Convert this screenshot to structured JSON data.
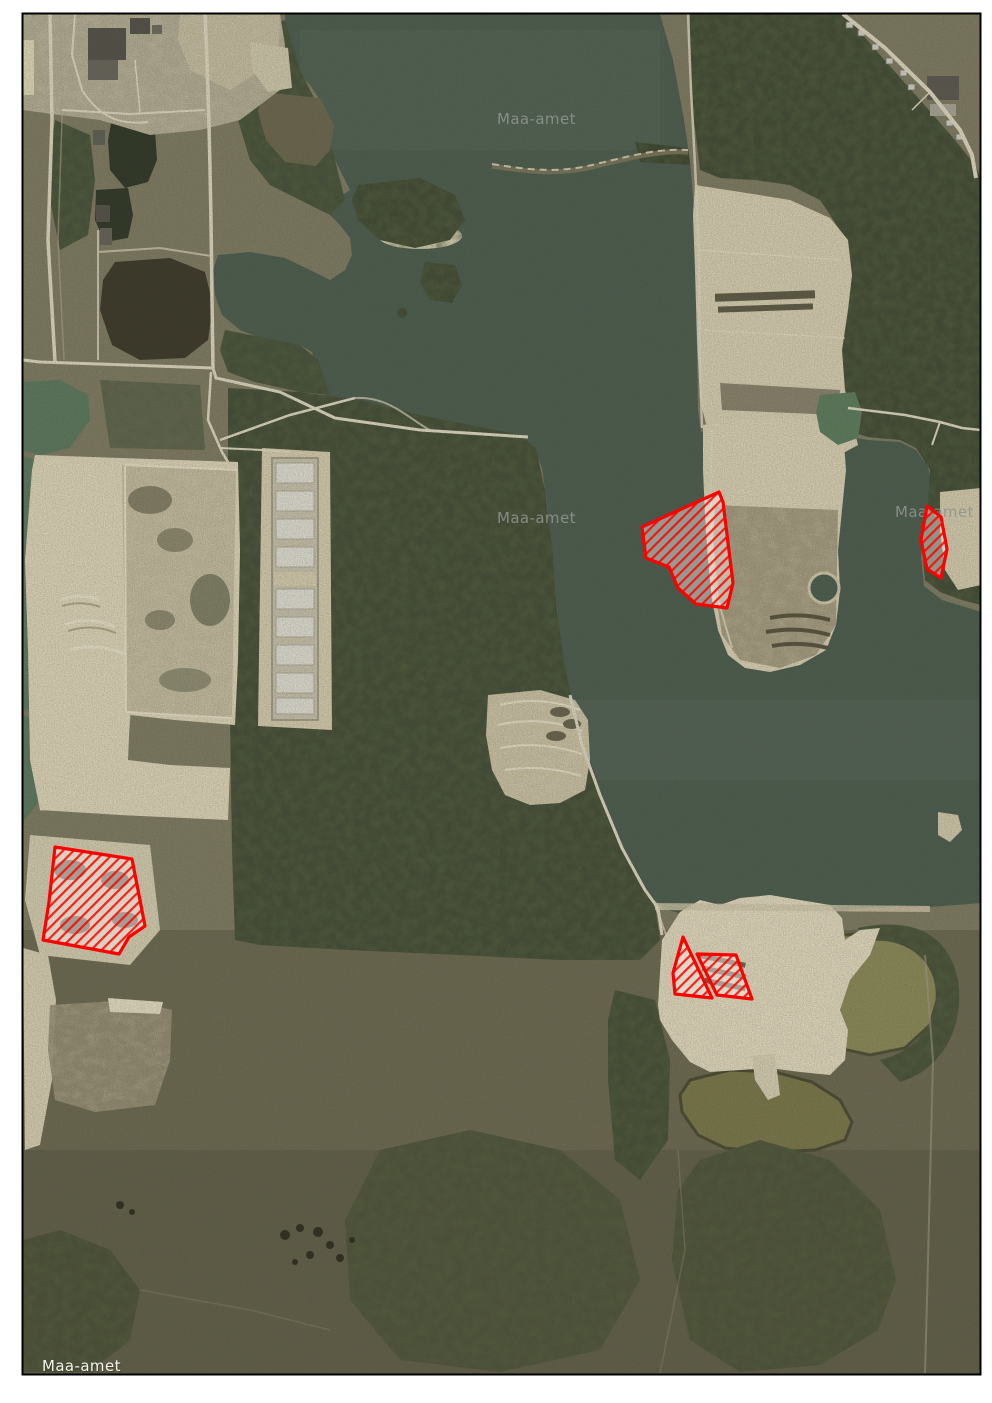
{
  "map": {
    "type": "orthophoto-aerial-map",
    "attribution": "Maa-amet",
    "frame": {
      "x": 22.5,
      "y": 13.5,
      "width": 958,
      "height": 1361,
      "border_color": "#000000",
      "margin_color": "#ffffff"
    },
    "watermarks": [
      {
        "text": "Maa-amet",
        "x": 497,
        "y": 124,
        "style": "gray"
      },
      {
        "text": "Maa-amet",
        "x": 497,
        "y": 523,
        "style": "gray"
      },
      {
        "text": "Maa-amet",
        "x": 895,
        "y": 517,
        "style": "gray"
      },
      {
        "text": "Maa-amet",
        "x": 42,
        "y": 1371,
        "style": "white"
      }
    ],
    "overlay": {
      "stroke_color": "#ff0000",
      "stroke_width": 3.2,
      "hatch_line_color": "rgba(255,0,0,0.85)",
      "hatch_bg_color": "rgba(255,248,242,0.42)",
      "polygons": [
        {
          "id": "parcel-1",
          "points": [
            [
              719,
              492
            ],
            [
              642,
              527
            ],
            [
              646,
              558
            ],
            [
              669,
              567
            ],
            [
              678,
              588
            ],
            [
              696,
              604
            ],
            [
              727,
              608
            ],
            [
              733,
              583
            ],
            [
              723,
              502
            ]
          ]
        },
        {
          "id": "parcel-2",
          "points": [
            [
              927,
              506
            ],
            [
              941,
              517
            ],
            [
              947,
              549
            ],
            [
              941,
              578
            ],
            [
              927,
              569
            ],
            [
              921,
              540
            ]
          ]
        },
        {
          "id": "parcel-3",
          "points": [
            [
              55,
              847
            ],
            [
              132,
              859
            ],
            [
              145,
              926
            ],
            [
              129,
              937
            ],
            [
              119,
              954
            ],
            [
              43,
              940
            ],
            [
              49,
              902
            ]
          ]
        },
        {
          "id": "parcel-4",
          "points": [
            [
              683,
              937
            ],
            [
              712,
              998
            ],
            [
              675,
              994
            ],
            [
              673,
              973
            ]
          ]
        },
        {
          "id": "parcel-5",
          "points": [
            [
              697,
              954
            ],
            [
              736,
              955
            ],
            [
              752,
              999
            ],
            [
              717,
              995
            ]
          ]
        }
      ]
    }
  }
}
